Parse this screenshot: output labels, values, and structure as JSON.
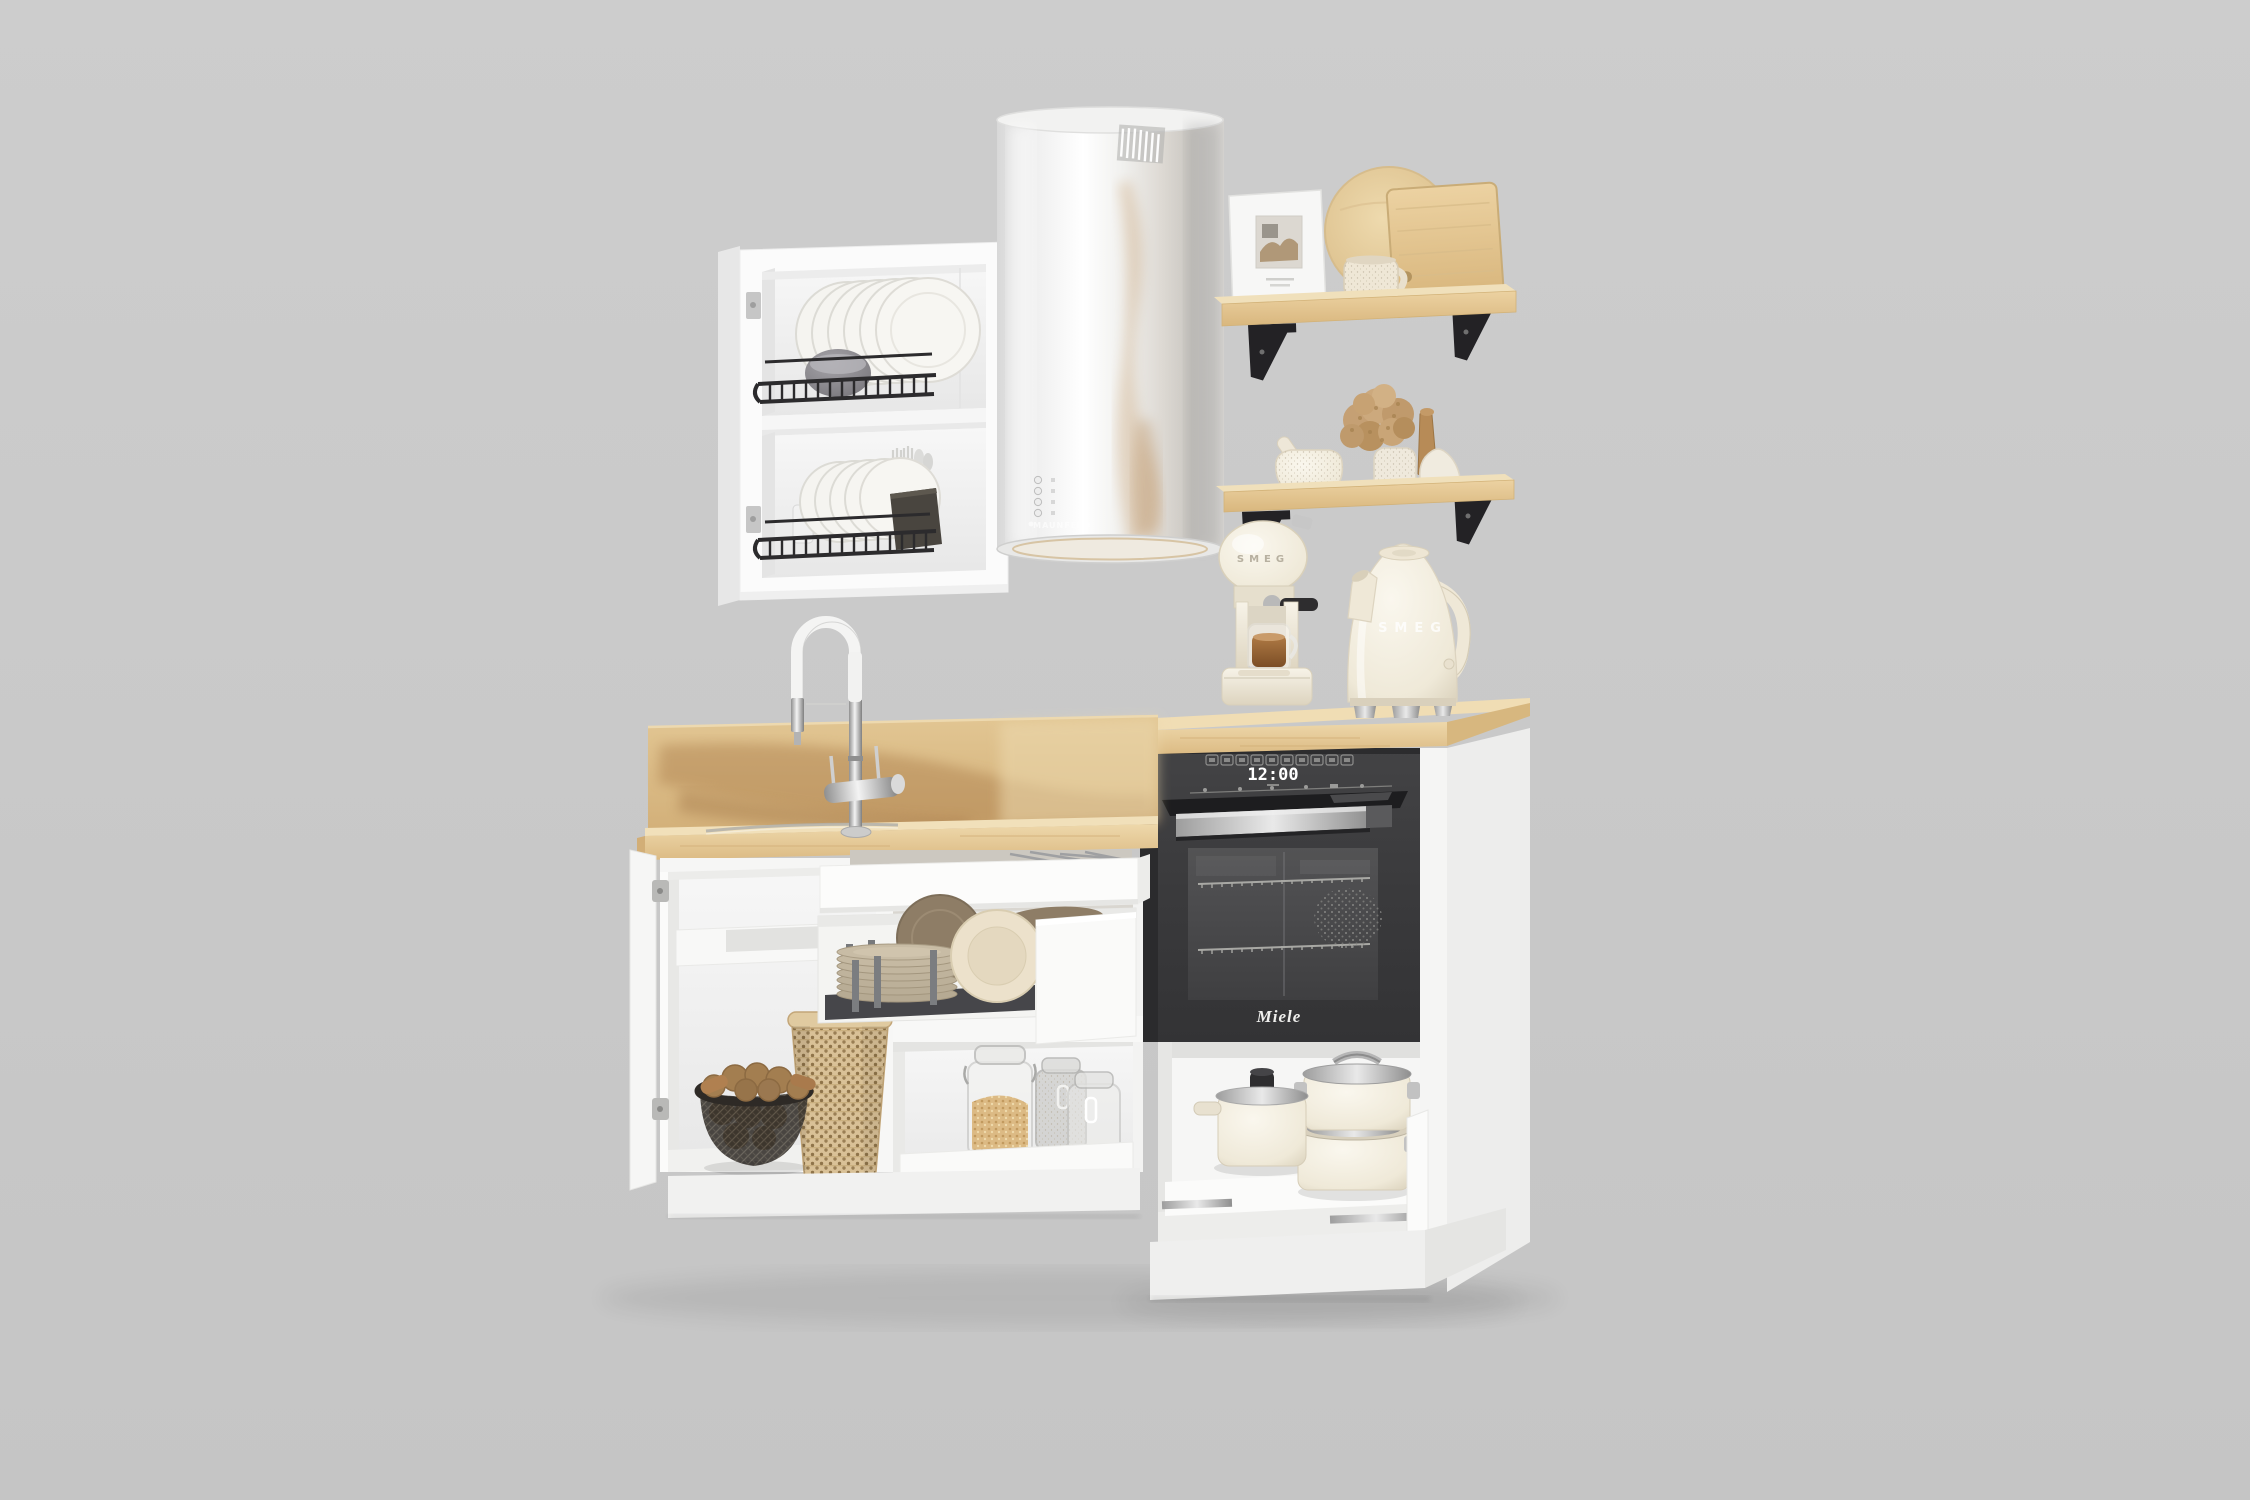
{
  "scene": {
    "description": "3D product render of a compact white kitchen set with oak worktop, open cabinets and built-in appliances on a plain grey studio background",
    "background_color": "#c9c9c9"
  },
  "wall_cabinet": {
    "type": "open two-compartment wall cabinet",
    "color": "#fbfbfb",
    "top_compartment_items": [
      "black wire dish rack",
      "six white plates",
      "grey bowl"
    ],
    "bottom_compartment_items": [
      "black wire dish rack",
      "white plates",
      "two frosted glasses",
      "dark cutlery box with forks and spoons"
    ]
  },
  "range_hood": {
    "brand_label": "MAUNFELD",
    "shape": "cylindrical island range hood",
    "finish": "white steel with warm reflections",
    "control_buttons": 4
  },
  "upper_shelf": {
    "material": "light oak board on black steel brackets",
    "items": [
      "white picture frame with small artwork",
      "round wooden cutting board",
      "rectangular wooden cutting board",
      "speckled beige mug"
    ]
  },
  "lower_shelf": {
    "material": "light oak board on black steel brackets",
    "items": [
      "beige mortar and pestle",
      "speckled vase with dried beige hydrangea",
      "wooden muddler",
      "small white vase"
    ]
  },
  "coffee_machine": {
    "brand_label": "SMEG",
    "color": "cream",
    "detail": "glass cup of coffee under group head, black steam wand"
  },
  "kettle": {
    "brand_label": "SMEG",
    "color": "cream",
    "detail": "dome body, cream handle, steel feet"
  },
  "worktop": {
    "material": "light oak",
    "backsplash": "oak panel with dark grain wash",
    "sink": "inset stainless trough",
    "faucet": "chrome gooseneck with white flexible hose and twin levers"
  },
  "oven": {
    "brand_label": "Miele",
    "clock_display": "12:00",
    "body_color": "#3a3a3c",
    "handle": "brushed steel bar",
    "icon_buttons_count": 10,
    "interior": "two chrome racks visible through dark glass"
  },
  "base_cabinets": {
    "left_cabinet": {
      "state": "door open",
      "items": [
        "white under-sink shelf",
        "black mesh basket with potatoes",
        "tall rattan basket"
      ]
    },
    "middle_cabinet": {
      "state": "two drawers pulled out",
      "top_drawer": "cutlery tray",
      "main_drawer_items": [
        "grey plate pegs",
        "stack of taupe plates",
        "standing brown plate",
        "standing cream plate"
      ],
      "lower_shelf_items": [
        "glass jar with grains",
        "frosted clip-top jar",
        "small clear jar"
      ]
    },
    "oven_cabinet": {
      "state": "pot drawer pulled out",
      "items": [
        "cream pot with black-knob steel lid",
        "two stacked cream pots with steel lids"
      ]
    },
    "plinth": "white recessed base"
  },
  "palette": {
    "background": "#c9c9c9",
    "cabinet_white": "#fbfbfb",
    "oak_light": "#ecd7ab",
    "oak_dark": "#a87947",
    "rack_black": "#2b2a2c",
    "oven_graphite": "#3a3a3c",
    "cream_appliance": "#f2ecdd",
    "steel": "#c0c0c0",
    "wicker": "#d9c197",
    "flower_beige": "#c8a377"
  }
}
